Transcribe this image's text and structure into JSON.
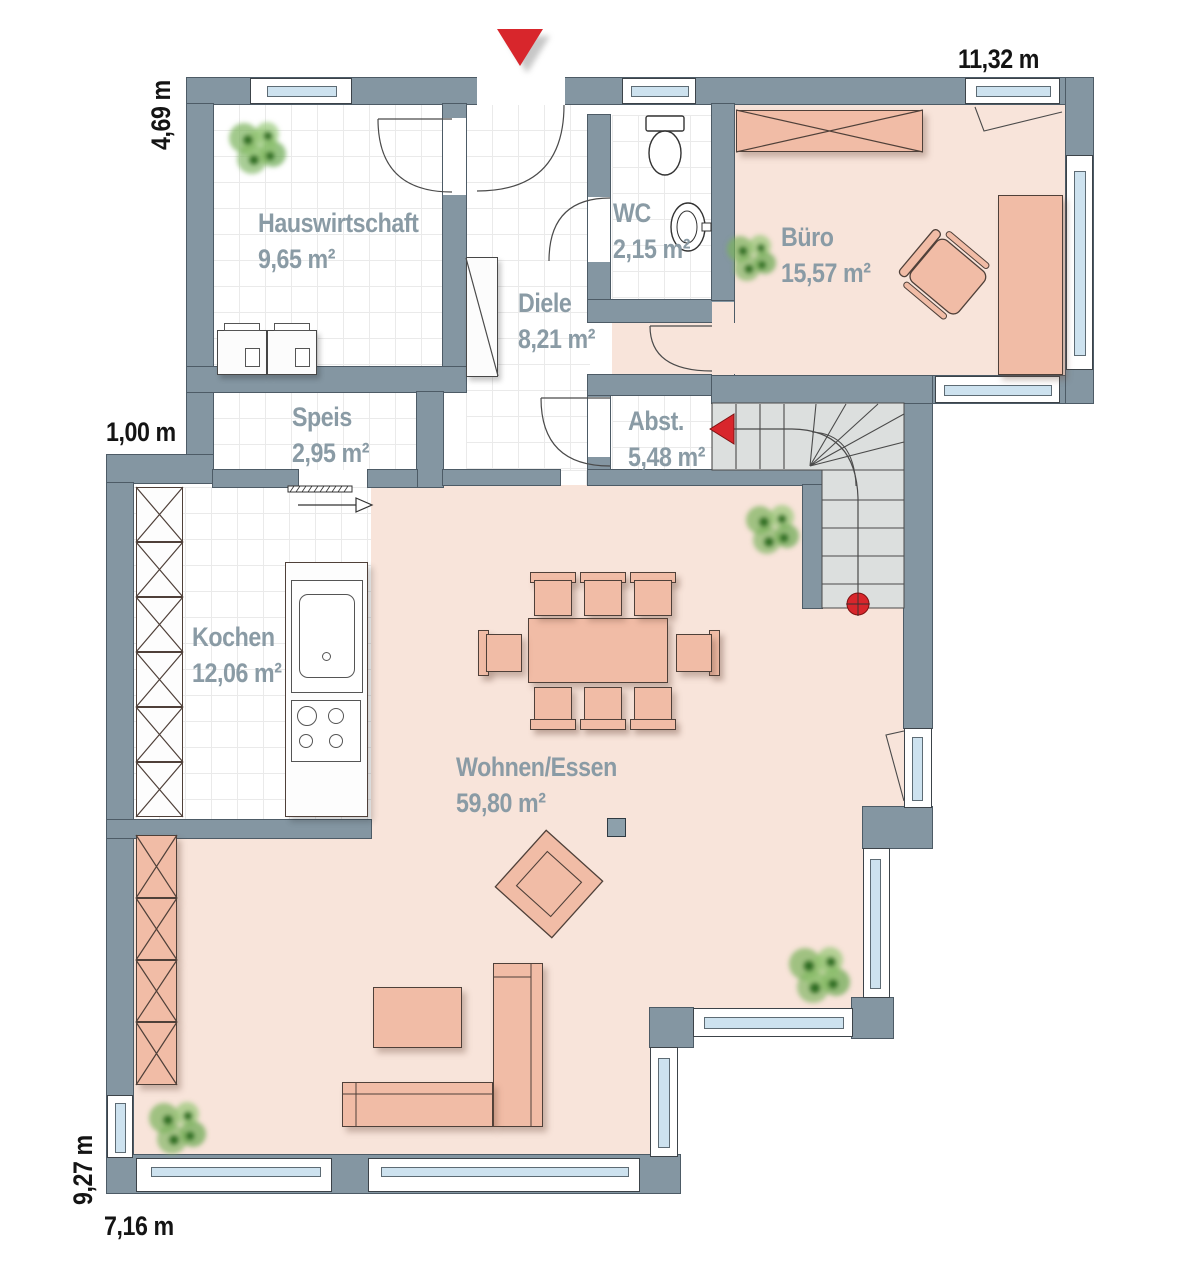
{
  "plan_title": "ground-floor-plan",
  "rooms": [
    {
      "name": "Hauswirtschaft",
      "area": "9,65 m²"
    },
    {
      "name": "WC",
      "area": "2,15 m²"
    },
    {
      "name": "Büro",
      "area": "15,57 m²"
    },
    {
      "name": "Diele",
      "area": "8,21 m²"
    },
    {
      "name": "Speis",
      "area": "2,95 m²"
    },
    {
      "name": "Abst.",
      "area": "5,48 m²"
    },
    {
      "name": "Kochen",
      "area": "12,06 m²"
    },
    {
      "name": "Wohnen/Essen",
      "area": "59,80 m²"
    }
  ],
  "dimensions": {
    "top": "11,32 m",
    "left_upper": "4,69 m",
    "left_step": "1,00 m",
    "left_lower": "9,27 m",
    "bottom": "7,16 m"
  },
  "markers": {
    "entrance": "red-triangle-down",
    "stair_direction": "red-arrow-left",
    "stair_start": "red-dot"
  },
  "colors": {
    "wall": "#8496a2",
    "floor_living": "#f8e4da",
    "furniture": "#f1bca6",
    "stairs": "#dcdfde",
    "window_glass": "#cde2ef",
    "accent_red": "#d8262c",
    "room_label": "#8a9ba5",
    "dimension_text": "#141414"
  }
}
